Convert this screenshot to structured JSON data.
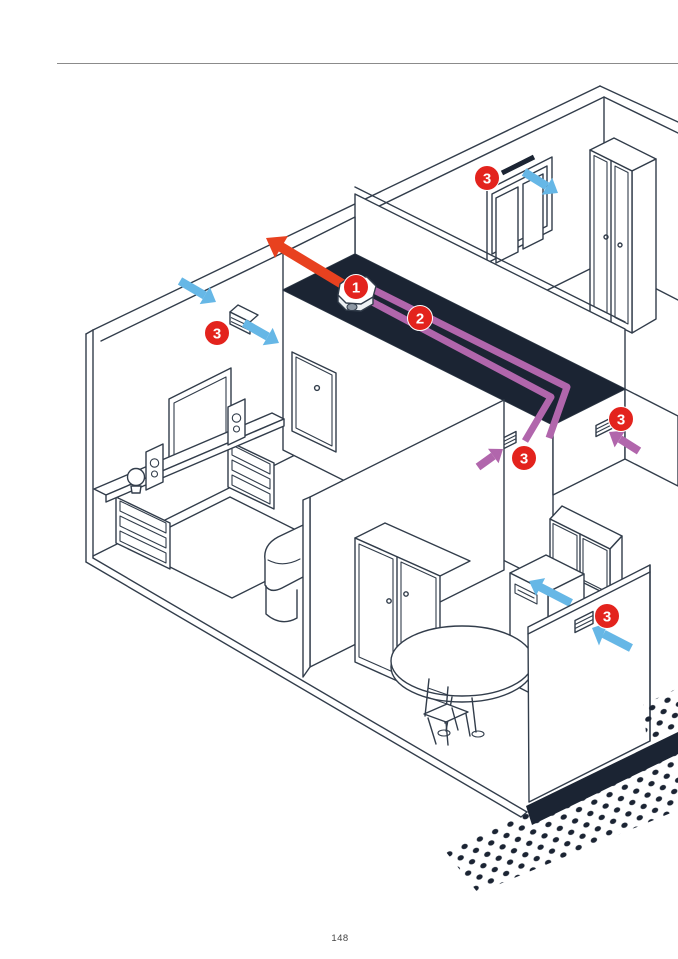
{
  "page": {
    "number": "148"
  },
  "colors": {
    "page_bg": "#ffffff",
    "line": "#323d4b",
    "dark_fill": "#1b2433",
    "supply_air_blue": "#66b7e6",
    "exhaust_red": "#e8411f",
    "transfer_purple": "#b166ac",
    "badge_red": "#e3231d",
    "rule_gray": "#8b8b8b"
  },
  "diagram": {
    "badges": {
      "unit": {
        "label": "1"
      },
      "duct": {
        "label": "2"
      },
      "vent_window": {
        "label": "3"
      },
      "vent_left_wall": {
        "label": "3"
      },
      "vent_hall": {
        "label": "3"
      },
      "vent_hall_right": {
        "label": "3"
      },
      "vent_outer_wall": {
        "label": "3"
      }
    }
  }
}
